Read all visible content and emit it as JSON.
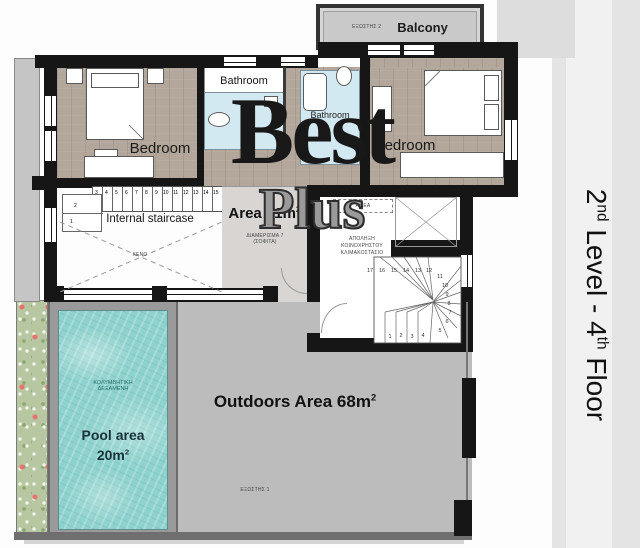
{
  "watermark": {
    "line1": "Best",
    "line2": "Plus"
  },
  "sidebar": {
    "t1": "2",
    "s1": "nd",
    "t2": " Level - 4",
    "s2": "th",
    "t3": " Floor"
  },
  "balcony": {
    "greek": "ΕΞΩΣΤΗΣ 2",
    "label": "Balcony"
  },
  "bedroom_left": {
    "label": "Bedroom"
  },
  "bedroom_right": {
    "label": "Bedroom"
  },
  "bathroom_top": {
    "label": "Bathroom"
  },
  "bathroom_mid": {
    "label": "Bathroom"
  },
  "internal_stair": {
    "label": "Internal staircase",
    "void_label": "ΚΕΝΟ",
    "steps": [
      "3",
      "4",
      "5",
      "6",
      "7",
      "8",
      "9",
      "10",
      "11",
      "12",
      "13",
      "14",
      "15"
    ],
    "lower_steps": [
      "2",
      "1"
    ]
  },
  "apartment": {
    "area_label": "Area 61m",
    "area_sup": "2",
    "greek_line1": "ΔΙΑΜΕΡΙΣΜΑ 7",
    "greek_line2": "(ΣΟΦΙΤΑ)"
  },
  "common_stair": {
    "amea": "ΑΜΕΑ",
    "greek_line1": "ΑΠΟΛΗΞΗ",
    "greek_line2": "ΚΟΙΝΟΧΡΗΣΤΟΥ",
    "greek_line3": "ΚΛΙΜΑΚΟΣΤΑΣΙΟ",
    "steps_top": [
      "17",
      "16",
      "15",
      "14",
      "13",
      "12"
    ],
    "steps_right": [
      "11",
      "10",
      "9",
      "8",
      "7",
      "6",
      "5"
    ],
    "steps_bottom": [
      "1",
      "2",
      "3",
      "4"
    ]
  },
  "pool": {
    "greek_line1": "ΚΟΛΥΜΒΗΤΙΚΗ",
    "greek_line2": "ΔΕΞΑΜΕΝΗ",
    "label_line1": "Pool area",
    "label_line2": "20m",
    "label_sup": "2"
  },
  "outdoors": {
    "label": "Outdoors Area 68m",
    "sup": "2",
    "greek": "ΕΞΩΣΤΗΣ 1"
  },
  "colors": {
    "wall": "#161616",
    "wood_floor": "#b2a79a",
    "bathroom_blue": "#d3e9f1",
    "outdoor_gray": "#bcbcbc",
    "pool_water": "#8ed2cd",
    "planter_green": "#b7c7a2",
    "sidebar_gray": "#e4e4e4",
    "balcony_gray": "#c9c9c9",
    "watermark_dark": "#181818",
    "watermark_gray": "#9a9a9a"
  }
}
